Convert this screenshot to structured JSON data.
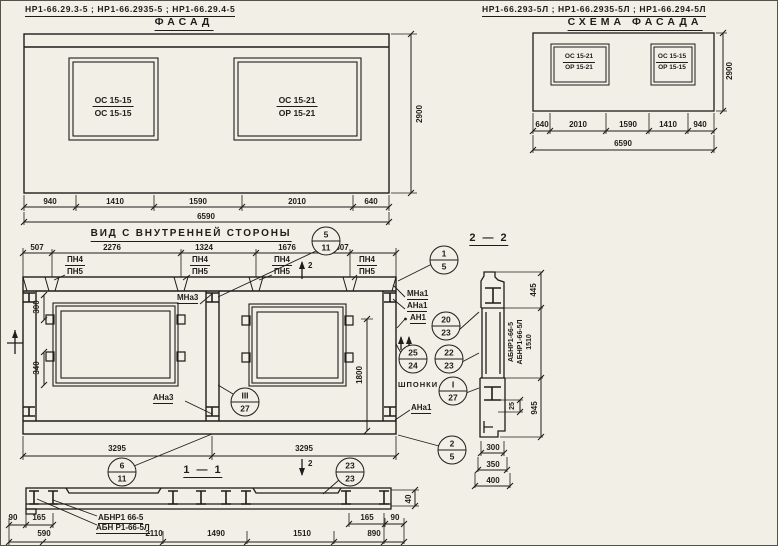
{
  "palette": {
    "paper": "#f2efe6",
    "ink": "#1e1d1a"
  },
  "facade": {
    "codes": "НР1-66.29.3-5 ;  НР1-66.2935-5 ;  НР1-66.29.4-5",
    "title": "ФАСАД",
    "win_left": {
      "top": "ОС 15-15",
      "bottom": "ОС 15-15"
    },
    "win_right": {
      "top": "ОС 15-21",
      "bottom": "ОР 15-21"
    },
    "dims": [
      "940",
      "1410",
      "1590",
      "2010",
      "640"
    ],
    "total": "6590",
    "height": "2900"
  },
  "schema": {
    "codes": "НР1-66.293-5Л ;  НР1-66.2935-5Л ;  НР1-66.294-5Л",
    "title": "СХЕМА ФАСАДА",
    "win_left": {
      "top": "ОС 15-21",
      "bottom": "ОР 15-21"
    },
    "win_right": {
      "top": "ОС 15-15",
      "bottom": "ОР 15-15"
    },
    "dims": [
      "640",
      "2010",
      "1590",
      "1410",
      "940"
    ],
    "total": "6590",
    "height": "2900"
  },
  "view": {
    "title": "ВИД С ВНУТРЕННЕЙ СТОРОНЫ",
    "dims_top": [
      "507",
      "2276",
      "1324",
      "1676",
      "807"
    ],
    "pn": {
      "top": "ПН4",
      "bottom": "ПН5"
    },
    "labels": {
      "mna3": "МНа3",
      "ana3": "АНа3",
      "mna1": "МНа1",
      "ana1": "АНа1",
      "an1": "АН1",
      "shponki": "ШПОНКИ",
      "ana1_b": "АНа1"
    },
    "dims": {
      "v300": "300",
      "v340": "340",
      "v1800": "1800",
      "b3295_l": "3295",
      "b3295_r": "3295"
    },
    "marker_top": "2",
    "marker_bottom": "2"
  },
  "callouts": {
    "c5_11": {
      "top": "5",
      "bottom": "11"
    },
    "c6_11": {
      "top": "6",
      "bottom": "11"
    },
    "c3_27": {
      "top": "III",
      "bottom": "27"
    },
    "c25_24": {
      "top": "25",
      "bottom": "24"
    },
    "c20_23": {
      "top": "20",
      "bottom": "23"
    },
    "c22_23": {
      "top": "22",
      "bottom": "23"
    },
    "cI_27": {
      "top": "I",
      "bottom": "27"
    },
    "c1_5": {
      "top": "1",
      "bottom": "5"
    },
    "c2_5": {
      "top": "2",
      "bottom": "5"
    },
    "c23_23": {
      "top": "23",
      "bottom": "23"
    }
  },
  "section11": {
    "title": "1 — 1",
    "label1": "АБНР1 66-5",
    "label2": "АБН Р1-66-5Л",
    "d90_l": "90",
    "d165_l": "165",
    "d590": "590",
    "d2110": "2110",
    "d1490": "1490",
    "d1510": "1510",
    "d890": "890",
    "d165_r": "165",
    "d90_r": "90",
    "d40": "40"
  },
  "section22": {
    "title": "2 — 2",
    "vlabel1": "АБНР1-66-5",
    "vlabel2": "АБНР1-66-5Л",
    "vlabel3": "1510",
    "d445": "445",
    "d25": "25",
    "d945": "945",
    "d300": "300",
    "d350": "350",
    "d400": "400"
  }
}
